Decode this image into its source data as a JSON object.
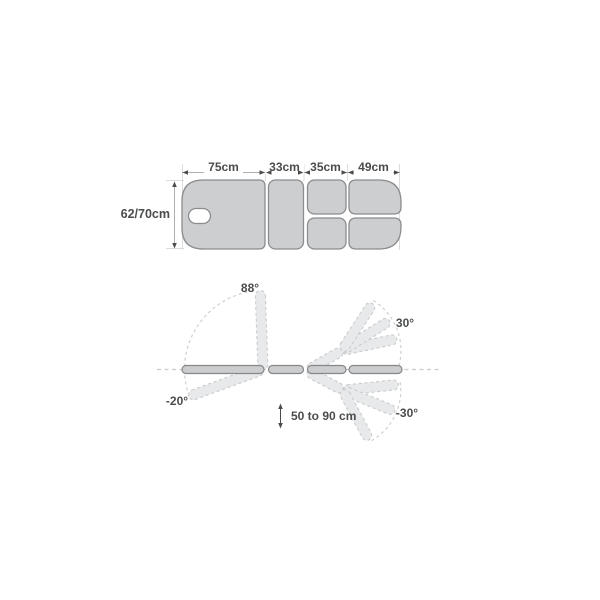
{
  "top_view": {
    "section_widths": [
      {
        "label": "75cm"
      },
      {
        "label": "33cm"
      },
      {
        "label": "35cm"
      },
      {
        "label": "49cm"
      }
    ],
    "table_width_label": "62/70cm"
  },
  "side_view": {
    "angles": {
      "head_up": "88°",
      "head_down": "-20°",
      "leg_up": "30°",
      "leg_down": "-30°"
    },
    "height_range_label": "50 to 90 cm"
  },
  "colors": {
    "section_fill": "#cdced0",
    "section_stroke": "#8a8c8e",
    "ghost_fill": "#e8e9ea",
    "ghost_stroke": "#c9cbcc",
    "dashed_centerline": "#cbcbcb",
    "dimension_line": "#b0b0b0",
    "extension_line": "#dcdcdc",
    "arrowhead": "#4c4c4c",
    "label_text": "#4a4c4e",
    "background": "#ffffff"
  }
}
